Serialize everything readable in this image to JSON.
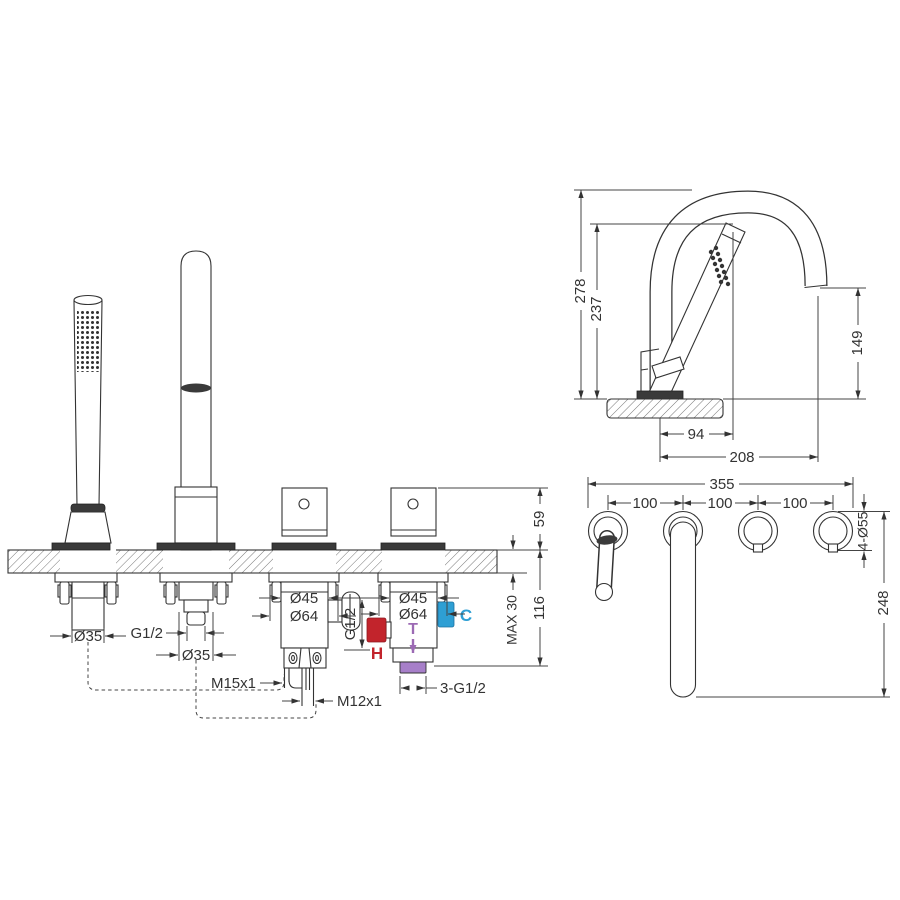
{
  "drawing": {
    "section_view": {
      "handset": {
        "shank_diameter": "Ø35"
      },
      "spout": {
        "thread": "G1/2",
        "shank_diameter": "Ø35"
      },
      "diverter": {
        "body_diameter": "Ø45",
        "base_diameter": "Ø64",
        "side_outlet_thread": "G1/2",
        "hose_thread_1": "M15x1",
        "hose_thread_2": "M12x1"
      },
      "mixer": {
        "body_diameter": "Ø45",
        "base_diameter": "Ø64",
        "inlet_threads": "3-G1/2",
        "hot_label": "H",
        "temp_label": "T",
        "cold_label": "C"
      },
      "height_above_deck": "59",
      "deck_thickness_max": "MAX 30",
      "depth_below_deck": "116"
    },
    "side_view": {
      "spout_total_height": "278",
      "handset_height": "237",
      "outlet_height": "149",
      "handset_offset": "94",
      "spout_reach": "208"
    },
    "plan_view": {
      "overall_width": "355",
      "hole_spacing": [
        "100",
        "100",
        "100"
      ],
      "hole_diameters": "4-Ø55",
      "spout_depth": "248"
    },
    "colors": {
      "hot": "#c2242c",
      "cold": "#2e9fd4",
      "temp": "#9c6ab4",
      "temp_light": "#a77fc9",
      "line": "#333333"
    }
  }
}
